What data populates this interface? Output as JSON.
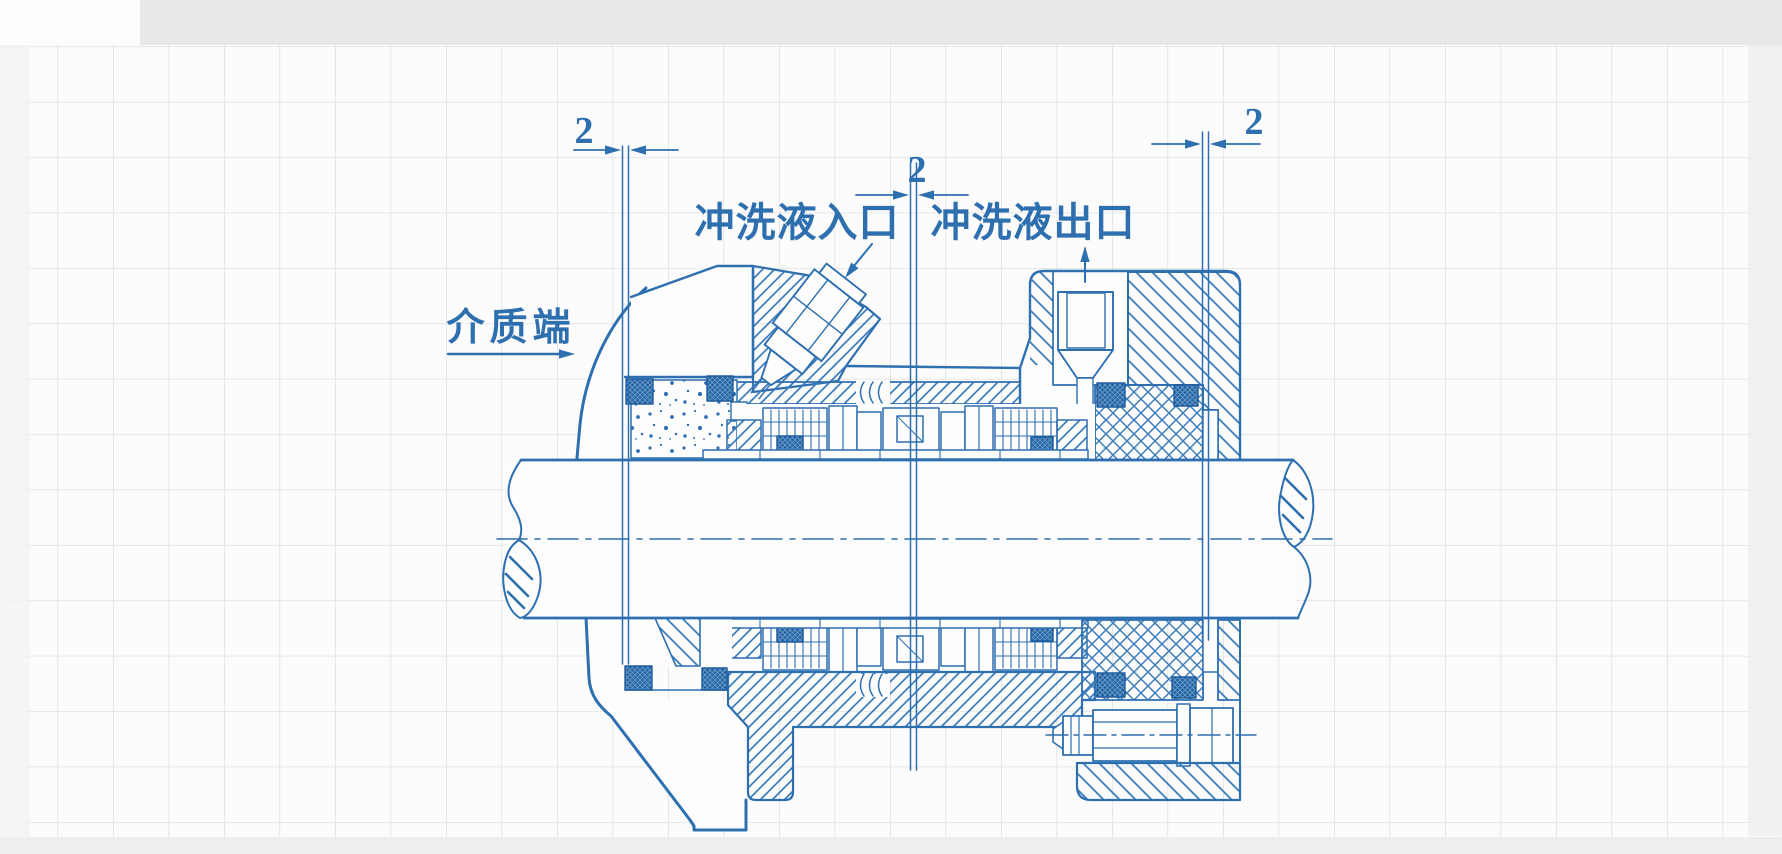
{
  "labels": {
    "medium_end": "介质端",
    "flush_inlet": "冲洗液入口",
    "flush_outlet": "冲洗液出口"
  },
  "dimensions": {
    "left_gap": "2",
    "middle_gap": "2",
    "right_gap": "2"
  },
  "colors": {
    "ink": "#2e6fb0",
    "ink_dark": "#1f5c9e",
    "hatch": "#3c7cba",
    "grid_line": "#d7dadd",
    "paper": "#fcfcfc",
    "scan_band": "#e8e8ea"
  }
}
